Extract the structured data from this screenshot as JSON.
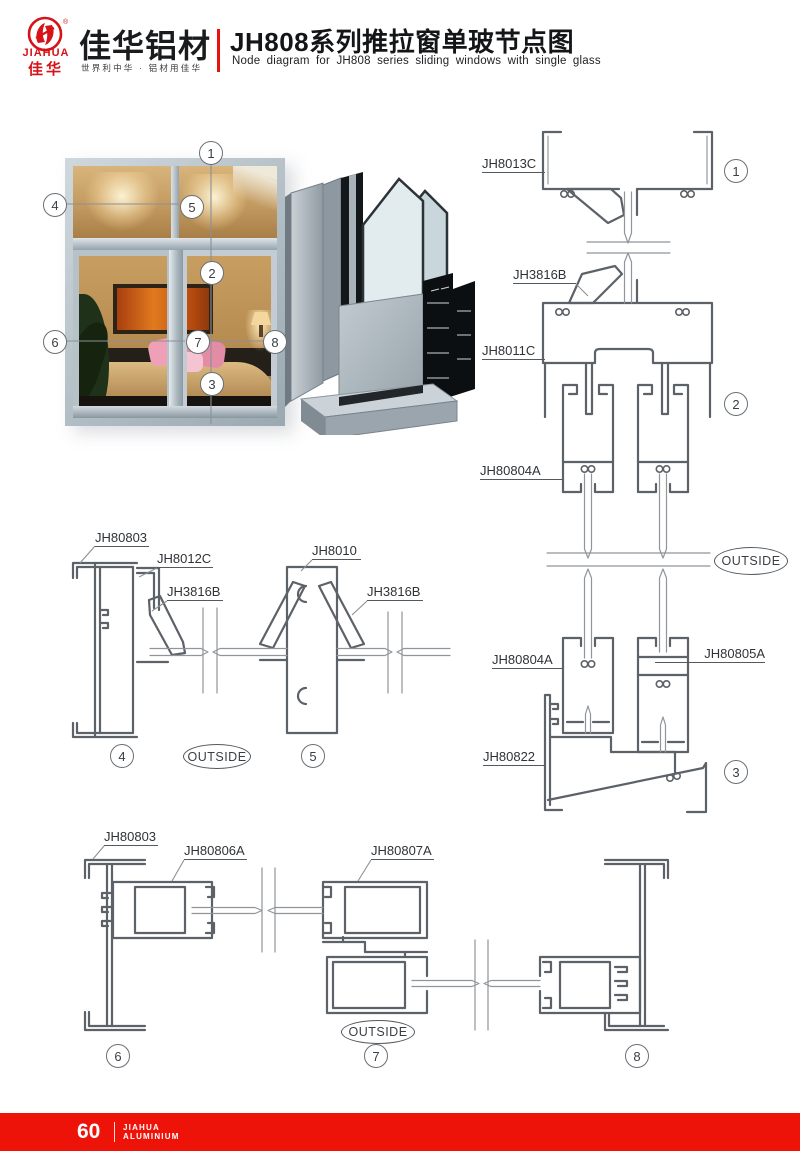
{
  "header": {
    "logo": {
      "mark_en": "JIAHUA",
      "mark_cn": "佳华",
      "registered": "®"
    },
    "brand_name": "佳华铝材",
    "slogan": "世界利中华 · 铝材用佳华",
    "title_cn": "JH808系列推拉窗单玻节点图",
    "title_en": "Node diagram for JH808 series sliding windows with single glass"
  },
  "colors": {
    "brand_red": "#e8140c",
    "drawing_stroke": "#5d6268"
  },
  "photo": {
    "callouts": [
      "1",
      "4",
      "5",
      "2",
      "6",
      "7",
      "8",
      "3"
    ]
  },
  "right_section": {
    "labels": [
      "JH8013C",
      "JH3816B",
      "JH8011C",
      "JH80804A",
      "JH80804A",
      "JH80805A",
      "JH80822"
    ],
    "outside": "OUTSIDE",
    "callouts": [
      "1",
      "2",
      "3"
    ]
  },
  "middle_section": {
    "labels": [
      "JH80803",
      "JH8012C",
      "JH3816B",
      "JH8010",
      "JH3816B"
    ],
    "outside": "OUTSIDE",
    "callouts": [
      "4",
      "5"
    ]
  },
  "bottom_section": {
    "labels": [
      "JH80803",
      "JH80806A",
      "JH80807A"
    ],
    "outside": "OUTSIDE",
    "callouts": [
      "6",
      "7",
      "8"
    ]
  },
  "footer": {
    "page_number": "60",
    "brand_line1": "JIAHUA",
    "brand_line2": "ALUMINIUM"
  }
}
